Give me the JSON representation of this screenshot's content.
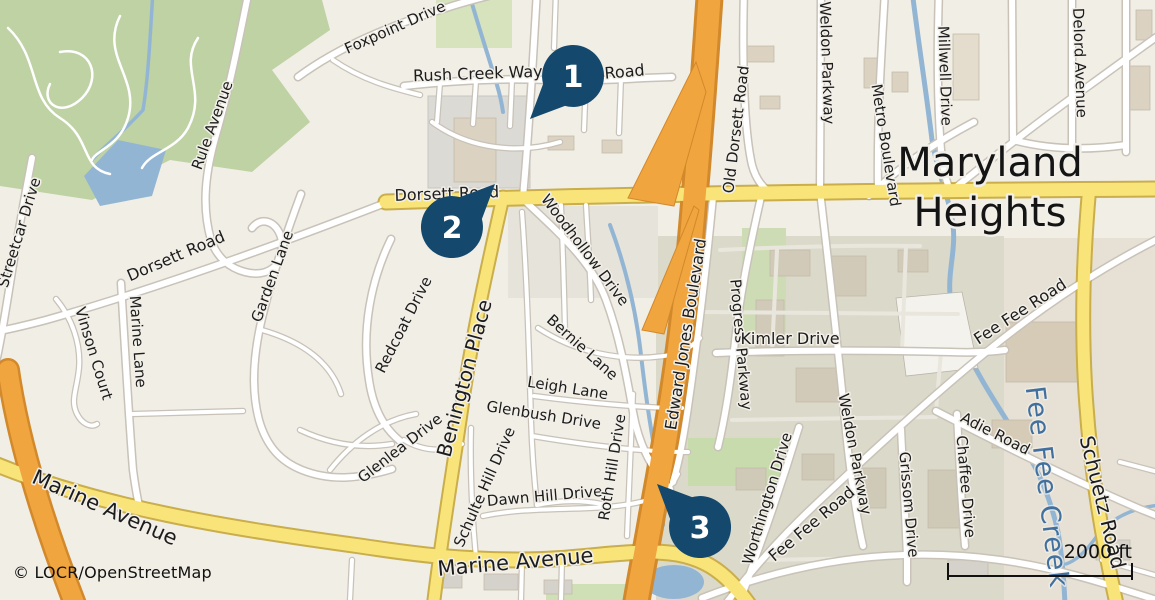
{
  "map": {
    "attribution": "© LOCR/OpenStreetMap",
    "scale_label": "2000 ft",
    "city": {
      "line1": "Maryland",
      "line2": "Heights"
    },
    "markers": [
      {
        "number": "1"
      },
      {
        "number": "2"
      },
      {
        "number": "3"
      }
    ],
    "colors": {
      "marker": "#14496d",
      "motorway": "#f1a53f",
      "primary_road": "#f9e47a",
      "water": "#93b5d4",
      "forest": "#bed2a4",
      "water_label": "#41709f"
    },
    "labels": {
      "foxpoint": "Foxpoint Drive",
      "rush_creek": "Rush Creek Way",
      "road_fragment": "Road",
      "dorsett_west": "Dorsett Road",
      "dorsett_center": "Dorsett Road",
      "old_dorsett": "Old Dorsett Road",
      "rule": "Rule Avenue",
      "streetcar": "Streetcar Drive",
      "garden": "Garden Lane",
      "marine_lane": "Marine Lane",
      "vinson": "Vinson Court",
      "redcoat": "Redcoat Drive",
      "benington": "Benington Place",
      "woodhollow": "Woodhollow Drive",
      "bernie": "Bernie Lane",
      "leigh": "Leigh Lane",
      "glenbush": "Glenbush Drive",
      "glenlea": "Glenlea Drive",
      "schulte": "Schulte Hill Drive",
      "dawn": "Dawn Hill Drive",
      "roth": "Roth Hill Drive",
      "marine_avenue_west": "Marine Avenue",
      "marine_avenue_south": "Marine Avenue",
      "edward_jones": "Edward Jones Boulevard",
      "progress": "Progress Parkway",
      "kimler": "Kimler Drive",
      "weldon_north": "Weldon Parkway",
      "weldon_south": "Weldon Parkway",
      "metro": "Metro Boulevard",
      "millwell": "Millwell Drive",
      "delord": "Delord Avenue",
      "fee_fee_ne": "Fee Fee Road",
      "fee_fee_south": "Fee Fee Road",
      "adie": "Adie Road",
      "worthington": "Worthington Drive",
      "grissom": "Grissom Drive",
      "chaffee": "Chaffee Drive",
      "schuetz": "Schuetz Road",
      "fee_fee_creek": "Fee Fee Creek"
    }
  }
}
